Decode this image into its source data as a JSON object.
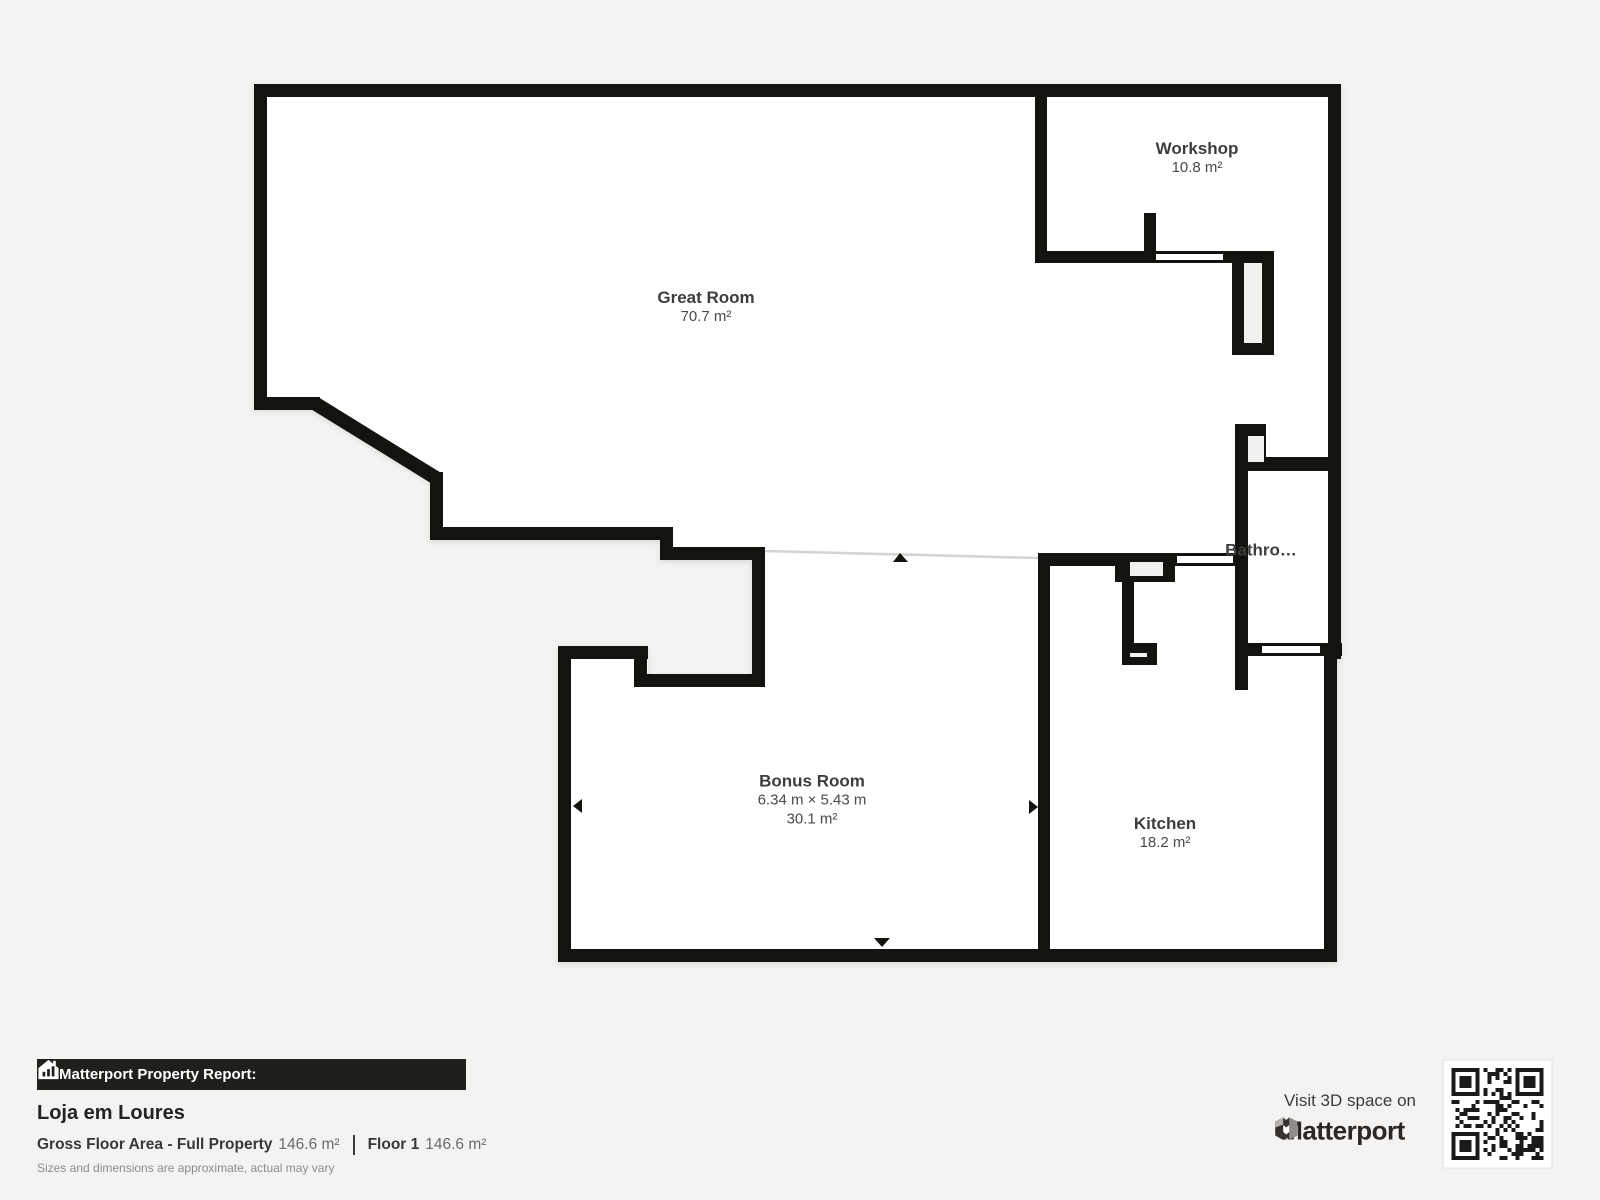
{
  "plan": {
    "rooms": {
      "great_room": {
        "name": "Great Room",
        "area": "70.7 m²"
      },
      "workshop": {
        "name": "Workshop",
        "area": "10.8 m²"
      },
      "bathroom": {
        "name": "Bathro…"
      },
      "bonus_room": {
        "name": "Bonus Room",
        "dimensions": "6.34 m × 5.43 m",
        "area": "30.1 m²"
      },
      "kitchen": {
        "name": "Kitchen",
        "area": "18.2 m²"
      }
    }
  },
  "report": {
    "bar_title": "Matterport Property Report:",
    "property_name": "Loja em Loures",
    "gross_label": "Gross Floor Area - Full Property",
    "gross_value": "146.6 m²",
    "floor_label": "Floor 1",
    "floor_value": "146.6 m²",
    "disclaimer": "Sizes and dimensions are approximate, actual may vary"
  },
  "promo": {
    "visit_text": "Visit 3D space on",
    "brand": "Matterport"
  },
  "colors": {
    "wall": "#151310",
    "floor": "#ffffff",
    "background": "#f4f3f1",
    "footer_bar": "#211f1c",
    "separator_line": "#d4d3d0"
  }
}
